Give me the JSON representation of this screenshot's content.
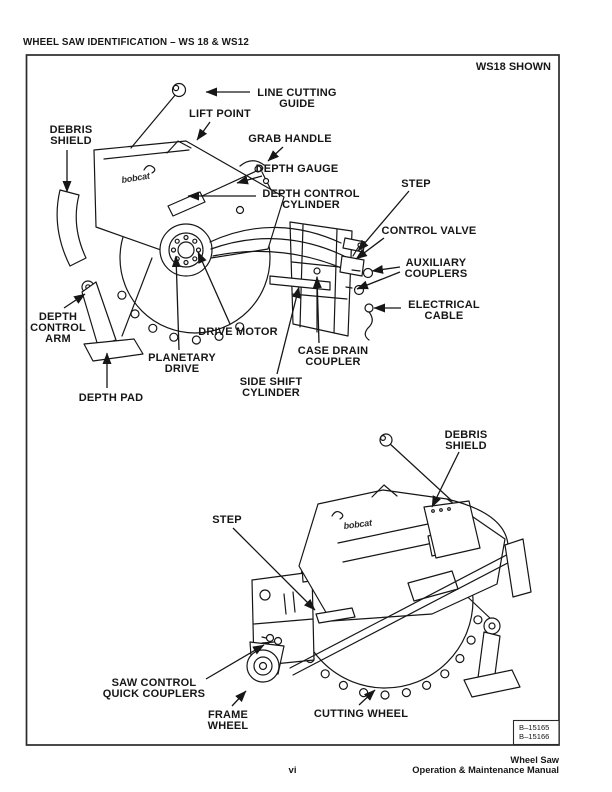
{
  "header": {
    "title": "WHEEL SAW IDENTIFICATION – WS 18 & WS12"
  },
  "figure": {
    "caption": "WS18 SHOWN",
    "brand_logo": "bobcat",
    "photo_refs": [
      "B–15165",
      "B–15166"
    ],
    "diagrams": [
      {
        "id": "top",
        "name": "wheel-saw-ws18-front-left-view",
        "callouts": [
          {
            "name": "line-cutting-guide",
            "lines": [
              "LINE CUTTING",
              "GUIDE"
            ],
            "tx": 297,
            "ty": 96,
            "leaders": [
              [
                250,
                92,
                206,
                92
              ]
            ]
          },
          {
            "name": "lift-point",
            "lines": [
              "LIFT POINT"
            ],
            "tx": 220,
            "ty": 117,
            "leaders": [
              [
                210,
                122,
                197,
                140
              ]
            ]
          },
          {
            "name": "grab-handle",
            "lines": [
              "GRAB HANDLE"
            ],
            "tx": 290,
            "ty": 142,
            "leaders": [
              [
                283,
                147,
                268,
                161
              ]
            ]
          },
          {
            "name": "depth-gauge",
            "lines": [
              "DEPTH GAUGE"
            ],
            "tx": 297,
            "ty": 172,
            "leaders": [
              [
                262,
                176,
                237,
                183
              ]
            ]
          },
          {
            "name": "depth-control-cylinder",
            "lines": [
              "DEPTH CONTROL",
              "CYLINDER"
            ],
            "tx": 311,
            "ty": 197,
            "leaders": [
              [
                256,
                196,
                188,
                196
              ]
            ]
          },
          {
            "name": "step",
            "lines": [
              "STEP"
            ],
            "tx": 416,
            "ty": 187,
            "leaders": [
              [
                409,
                191,
                358,
                251
              ]
            ]
          },
          {
            "name": "control-valve",
            "lines": [
              "CONTROL VALVE"
            ],
            "tx": 429,
            "ty": 234,
            "leaders": [
              [
                384,
                238,
                356,
                259
              ]
            ]
          },
          {
            "name": "auxiliary-couplers",
            "lines": [
              "AUXILIARY",
              "COUPLERS"
            ],
            "tx": 436,
            "ty": 266,
            "leaders": [
              [
                400,
                267,
                372,
                271
              ],
              [
                400,
                272,
                357,
                289
              ]
            ]
          },
          {
            "name": "electrical-cable",
            "lines": [
              "ELECTRICAL",
              "CABLE"
            ],
            "tx": 444,
            "ty": 308,
            "leaders": [
              [
                401,
                308,
                374,
                308
              ]
            ]
          },
          {
            "name": "debris-shield",
            "lines": [
              "DEBRIS",
              "SHIELD"
            ],
            "tx": 71,
            "ty": 133,
            "leaders": [
              [
                67,
                150,
                67,
                192
              ]
            ]
          },
          {
            "name": "depth-control-arm",
            "lines": [
              "DEPTH",
              "CONTROL",
              "ARM"
            ],
            "tx": 58,
            "ty": 320,
            "leaders": [
              [
                64,
                308,
                85,
                294
              ]
            ]
          },
          {
            "name": "depth-pad",
            "lines": [
              "DEPTH PAD"
            ],
            "tx": 111,
            "ty": 401,
            "leaders": [
              [
                107,
                388,
                107,
                353
              ]
            ]
          },
          {
            "name": "planetary-drive",
            "lines": [
              "PLANETARY",
              "DRIVE"
            ],
            "tx": 182,
            "ty": 361,
            "leaders": [
              [
                179,
                350,
                176,
                256
              ]
            ]
          },
          {
            "name": "drive-motor",
            "lines": [
              "DRIVE MOTOR"
            ],
            "tx": 238,
            "ty": 335,
            "leaders": [
              [
                230,
                324,
                198,
                252
              ]
            ]
          },
          {
            "name": "case-drain-coupler",
            "lines": [
              "CASE DRAIN",
              "COUPLER"
            ],
            "tx": 333,
            "ty": 354,
            "leaders": [
              [
                319,
                343,
                317,
                277
              ]
            ]
          },
          {
            "name": "side-shift-cylinder",
            "lines": [
              "SIDE SHIFT",
              "CYLINDER"
            ],
            "tx": 271,
            "ty": 385,
            "leaders": [
              [
                277,
                374,
                299,
                287
              ]
            ]
          }
        ]
      },
      {
        "id": "bottom",
        "name": "wheel-saw-ws18-rear-right-view",
        "callouts": [
          {
            "name": "debris-shield",
            "lines": [
              "DEBRIS",
              "SHIELD"
            ],
            "tx": 466,
            "ty": 438,
            "leaders": [
              [
                459,
                452,
                432,
                507
              ]
            ]
          },
          {
            "name": "step",
            "lines": [
              "STEP"
            ],
            "tx": 227,
            "ty": 523,
            "leaders": [
              [
                233,
                528,
                315,
                610
              ]
            ]
          },
          {
            "name": "saw-control-quick-couplers",
            "lines": [
              "SAW CONTROL",
              "QUICK COUPLERS"
            ],
            "tx": 154,
            "ty": 686,
            "leaders": [
              [
                206,
                679,
                264,
                645
              ]
            ]
          },
          {
            "name": "frame-wheel",
            "lines": [
              "FRAME",
              "WHEEL"
            ],
            "tx": 228,
            "ty": 718,
            "leaders": [
              [
                232,
                706,
                246,
                691
              ]
            ]
          },
          {
            "name": "cutting-wheel",
            "lines": [
              "CUTTING WHEEL"
            ],
            "tx": 361,
            "ty": 717,
            "leaders": [
              [
                359,
                705,
                375,
                690
              ]
            ]
          }
        ]
      }
    ]
  },
  "footer": {
    "page_number": "vi",
    "manual_title_line1": "Wheel Saw",
    "manual_title_line2": "Operation & Maintenance Manual"
  }
}
